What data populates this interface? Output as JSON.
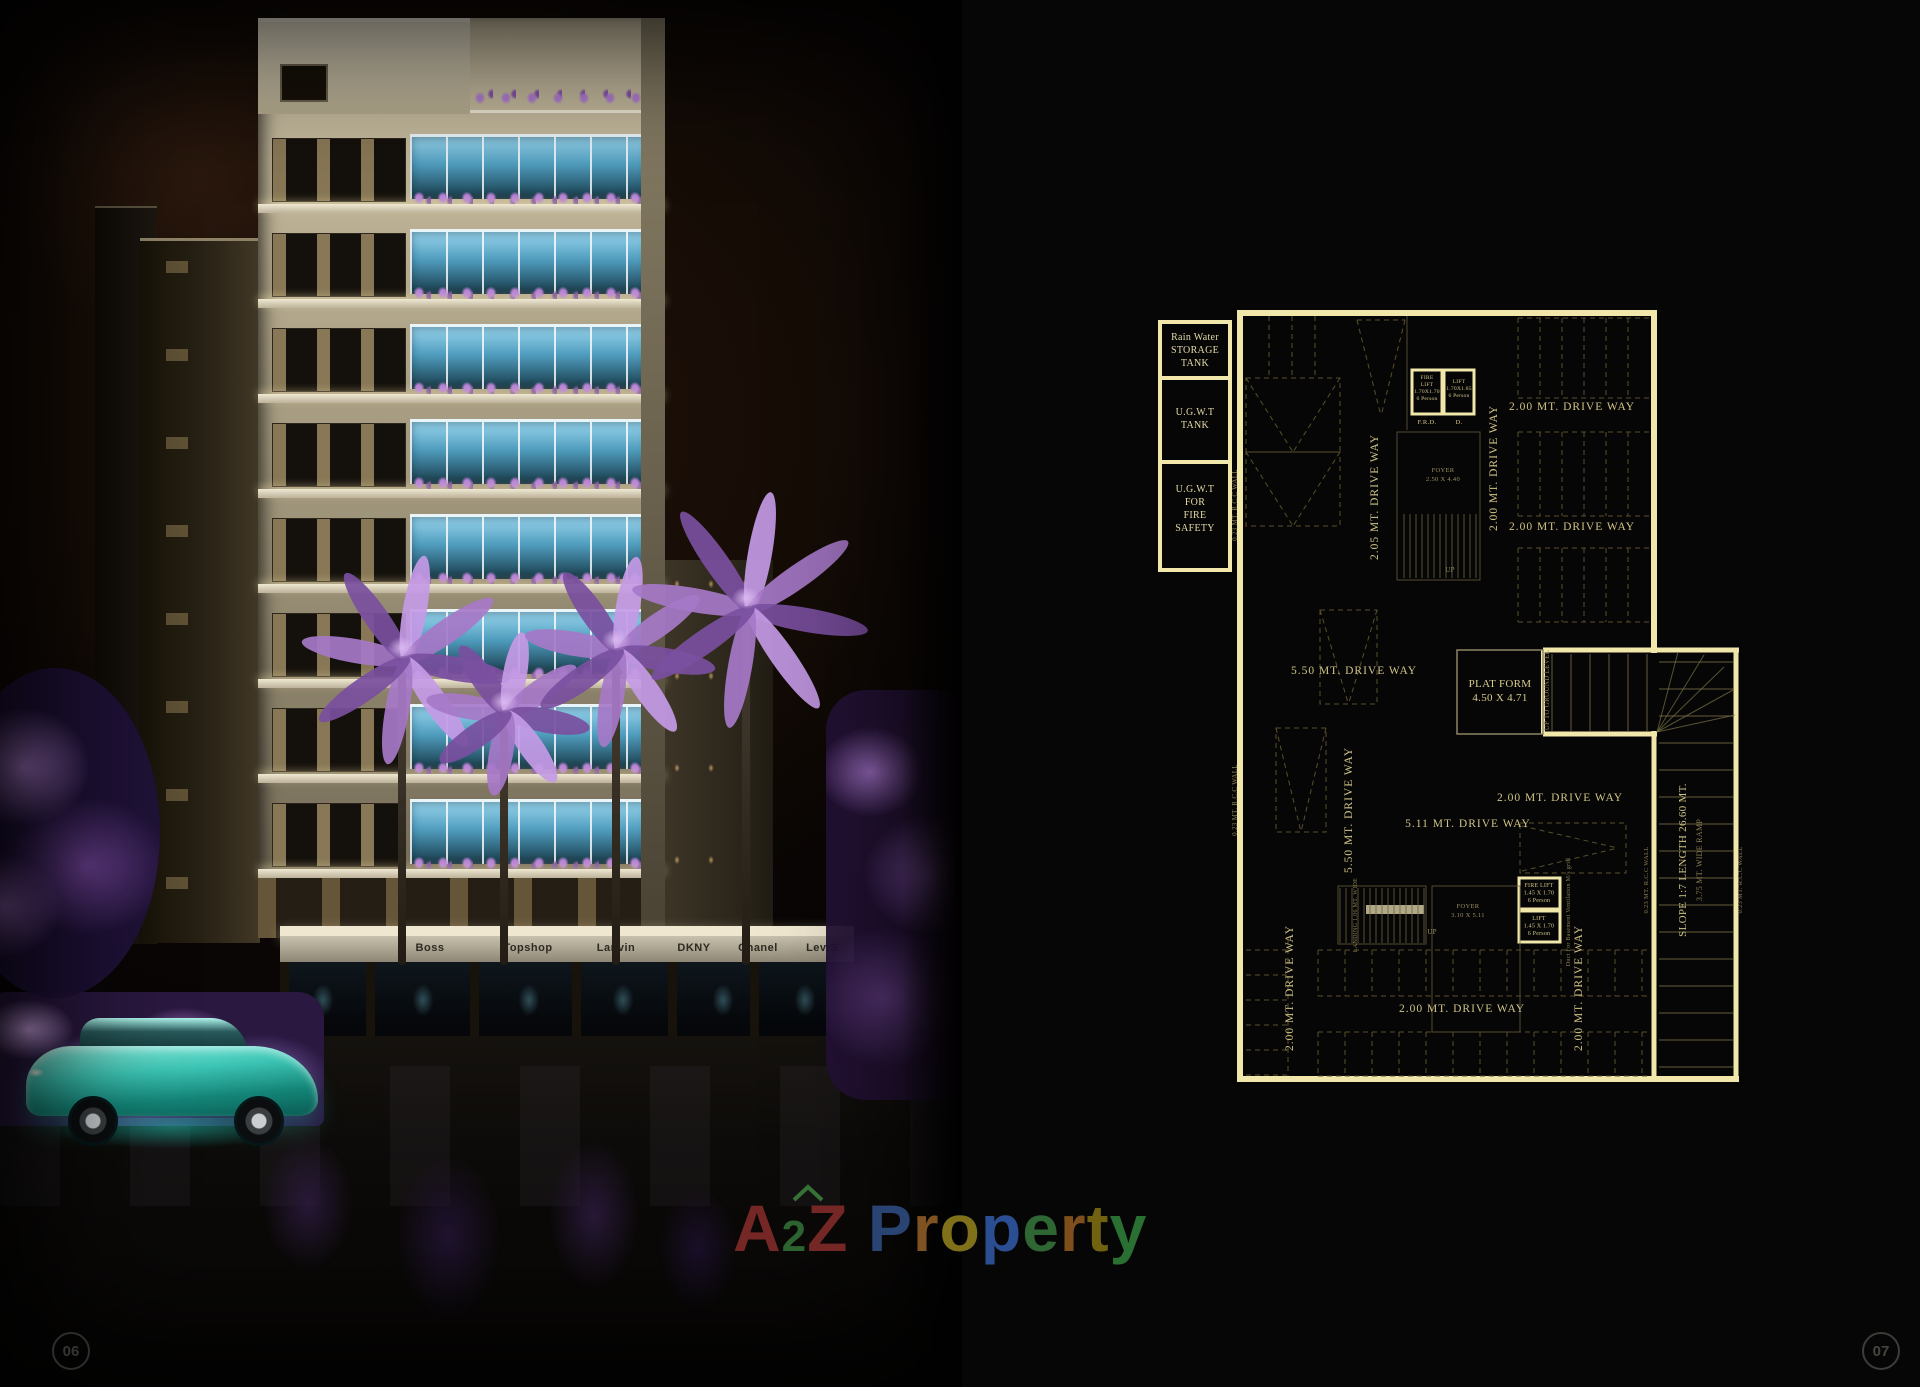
{
  "page": {
    "left_number": "06",
    "right_number": "07"
  },
  "watermarks": {
    "url_pre": "www.A",
    "url_sub": "2",
    "url_post": "ZProperty.in",
    "ghost": "BASEMENT",
    "subtitle": "BASEMENT LAYOUT PLAN"
  },
  "logo": {
    "letters": [
      {
        "ch": "A",
        "color": "#7e2a28"
      },
      {
        "ch": "2",
        "color": "#2f6b33",
        "small": true
      },
      {
        "ch": "Z",
        "color": "#7e2a28"
      },
      {
        "ch": " ",
        "color": "#000000"
      },
      {
        "ch": "P",
        "color": "#2c4a7c"
      },
      {
        "ch": "r",
        "color": "#8a5a24"
      },
      {
        "ch": "o",
        "color": "#8a7a1c"
      },
      {
        "ch": "p",
        "color": "#2f55a0"
      },
      {
        "ch": "e",
        "color": "#337038"
      },
      {
        "ch": "r",
        "color": "#8a5520"
      },
      {
        "ch": "t",
        "color": "#7a6a14"
      },
      {
        "ch": "y",
        "color": "#2e7a36"
      }
    ],
    "house_icon": "house-roof-icon",
    "house_color": "#3a7a3a"
  },
  "photo": {
    "shop_signs": [
      "Boss",
      "Topshop",
      "Lanvin",
      "DKNY",
      "Chanel",
      "LeviS"
    ]
  },
  "plan": {
    "tanks": [
      [
        "Rain Water",
        "STORAGE",
        "TANK"
      ],
      [
        "U.G.W.T",
        "TANK"
      ],
      [
        "U.G.W.T",
        "FOR",
        "FIRE",
        "SAFETY"
      ]
    ],
    "driveway_labels": [
      "2.05 MT. DRIVE WAY",
      "2.00 MT. DRIVE WAY",
      "2.00 MT. DRIVE WAY",
      "2.00 MT. DRIVE WAY",
      "5.50 MT. DRIVE WAY",
      "5.50 MT. DRIVE WAY",
      "5.11 MT. DRIVE WAY",
      "2.00 MT. DRIVE WAY",
      "2.00 MT. DRIVE WAY",
      "2.00 MT. DRIVE WAY",
      "2.00 MT. DRIVE WAY"
    ],
    "misc_labels": [
      "PLAT FORM",
      "4.50 X 4.71",
      "SLOPE 1:7  LENGTH 26.60 MT.",
      "3.75 MT. WIDE RAMP",
      "0.23 MT. R.C.C WALL",
      "0.23 MT. R.C.C WALL",
      "0.23 MT. R.C.C WALL",
      "0.23 MT. R.C.C WALL",
      "UP TO GROUND LEVEL",
      "F.R.D.",
      "D.",
      "FOYER",
      "2.50 X 4.40",
      "FOYER",
      "3.10 X 5.11",
      "UP",
      "UP",
      "LANDING 1.06 MT. WIDE",
      "Duct For Basement Ventilation M/s grill"
    ],
    "lifts": [
      [
        "FIRE",
        "LIFT",
        "1.70X1.70",
        "6 Person"
      ],
      [
        "LIFT",
        "1.70X1.85",
        "6 Person"
      ],
      [
        "FIRE LIFT",
        "1.45 X 1.70",
        "6 Person"
      ],
      [
        "LIFT",
        "1.45 X 1.70",
        "6 Person"
      ]
    ],
    "road_label": "12.00 MT. WIDE ROAD"
  },
  "colors": {
    "wall": "#f2e7ab",
    "plan_text": "#cfc387",
    "plan_dim": "#8a7f54",
    "stall_dash": "#57502a",
    "rung": "#7a7148",
    "watermark_gray": "#6e6d66",
    "road_text": "#e6dca6",
    "car_teal": "#3cc4b4",
    "foliage_purple": "#a678c8"
  }
}
